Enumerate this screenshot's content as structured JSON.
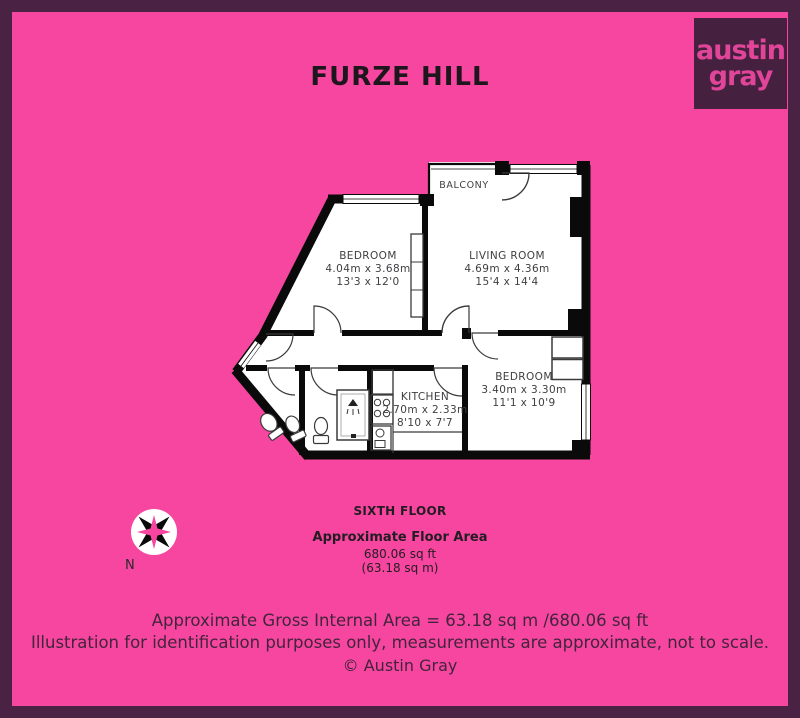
{
  "title": "FURZE HILL",
  "logo": {
    "line1": "austin",
    "line2": "gray"
  },
  "floorplan": {
    "rooms": [
      {
        "name": "BALCONY",
        "metric": "",
        "imperial": ""
      },
      {
        "name": "BEDROOM",
        "metric": "4.04m x 3.68m",
        "imperial": "13'3 x 12'0"
      },
      {
        "name": "LIVING ROOM",
        "metric": "4.69m x 4.36m",
        "imperial": "15'4 x 14'4"
      },
      {
        "name": "KITCHEN",
        "metric": "2.70m x 2.33m",
        "imperial": "8'10 x 7'7"
      },
      {
        "name": "BEDROOM",
        "metric": "3.40m x 3.30m",
        "imperial": "11'1 x 10'9"
      }
    ],
    "compass_label": "N"
  },
  "floor_info": {
    "floor": "SIXTH FLOOR",
    "area_heading": "Approximate Floor Area",
    "area_sqft": "680.06 sq ft",
    "area_sqm": "(63.18 sq m)"
  },
  "footer": {
    "line1": "Approximate Gross Internal Area = 63.18 sq m /680.06 sq ft",
    "line2": "Illustration for identification purposes only, measurements are approximate, not to scale.",
    "line3": "© Austin Gray"
  },
  "colors": {
    "background": "#F6469F",
    "border": "#4A2344",
    "logo_background": "#46203F",
    "logo_text": "#E0459A",
    "wall": "#0A0A0A",
    "room_fill": "#FFFFFF"
  }
}
